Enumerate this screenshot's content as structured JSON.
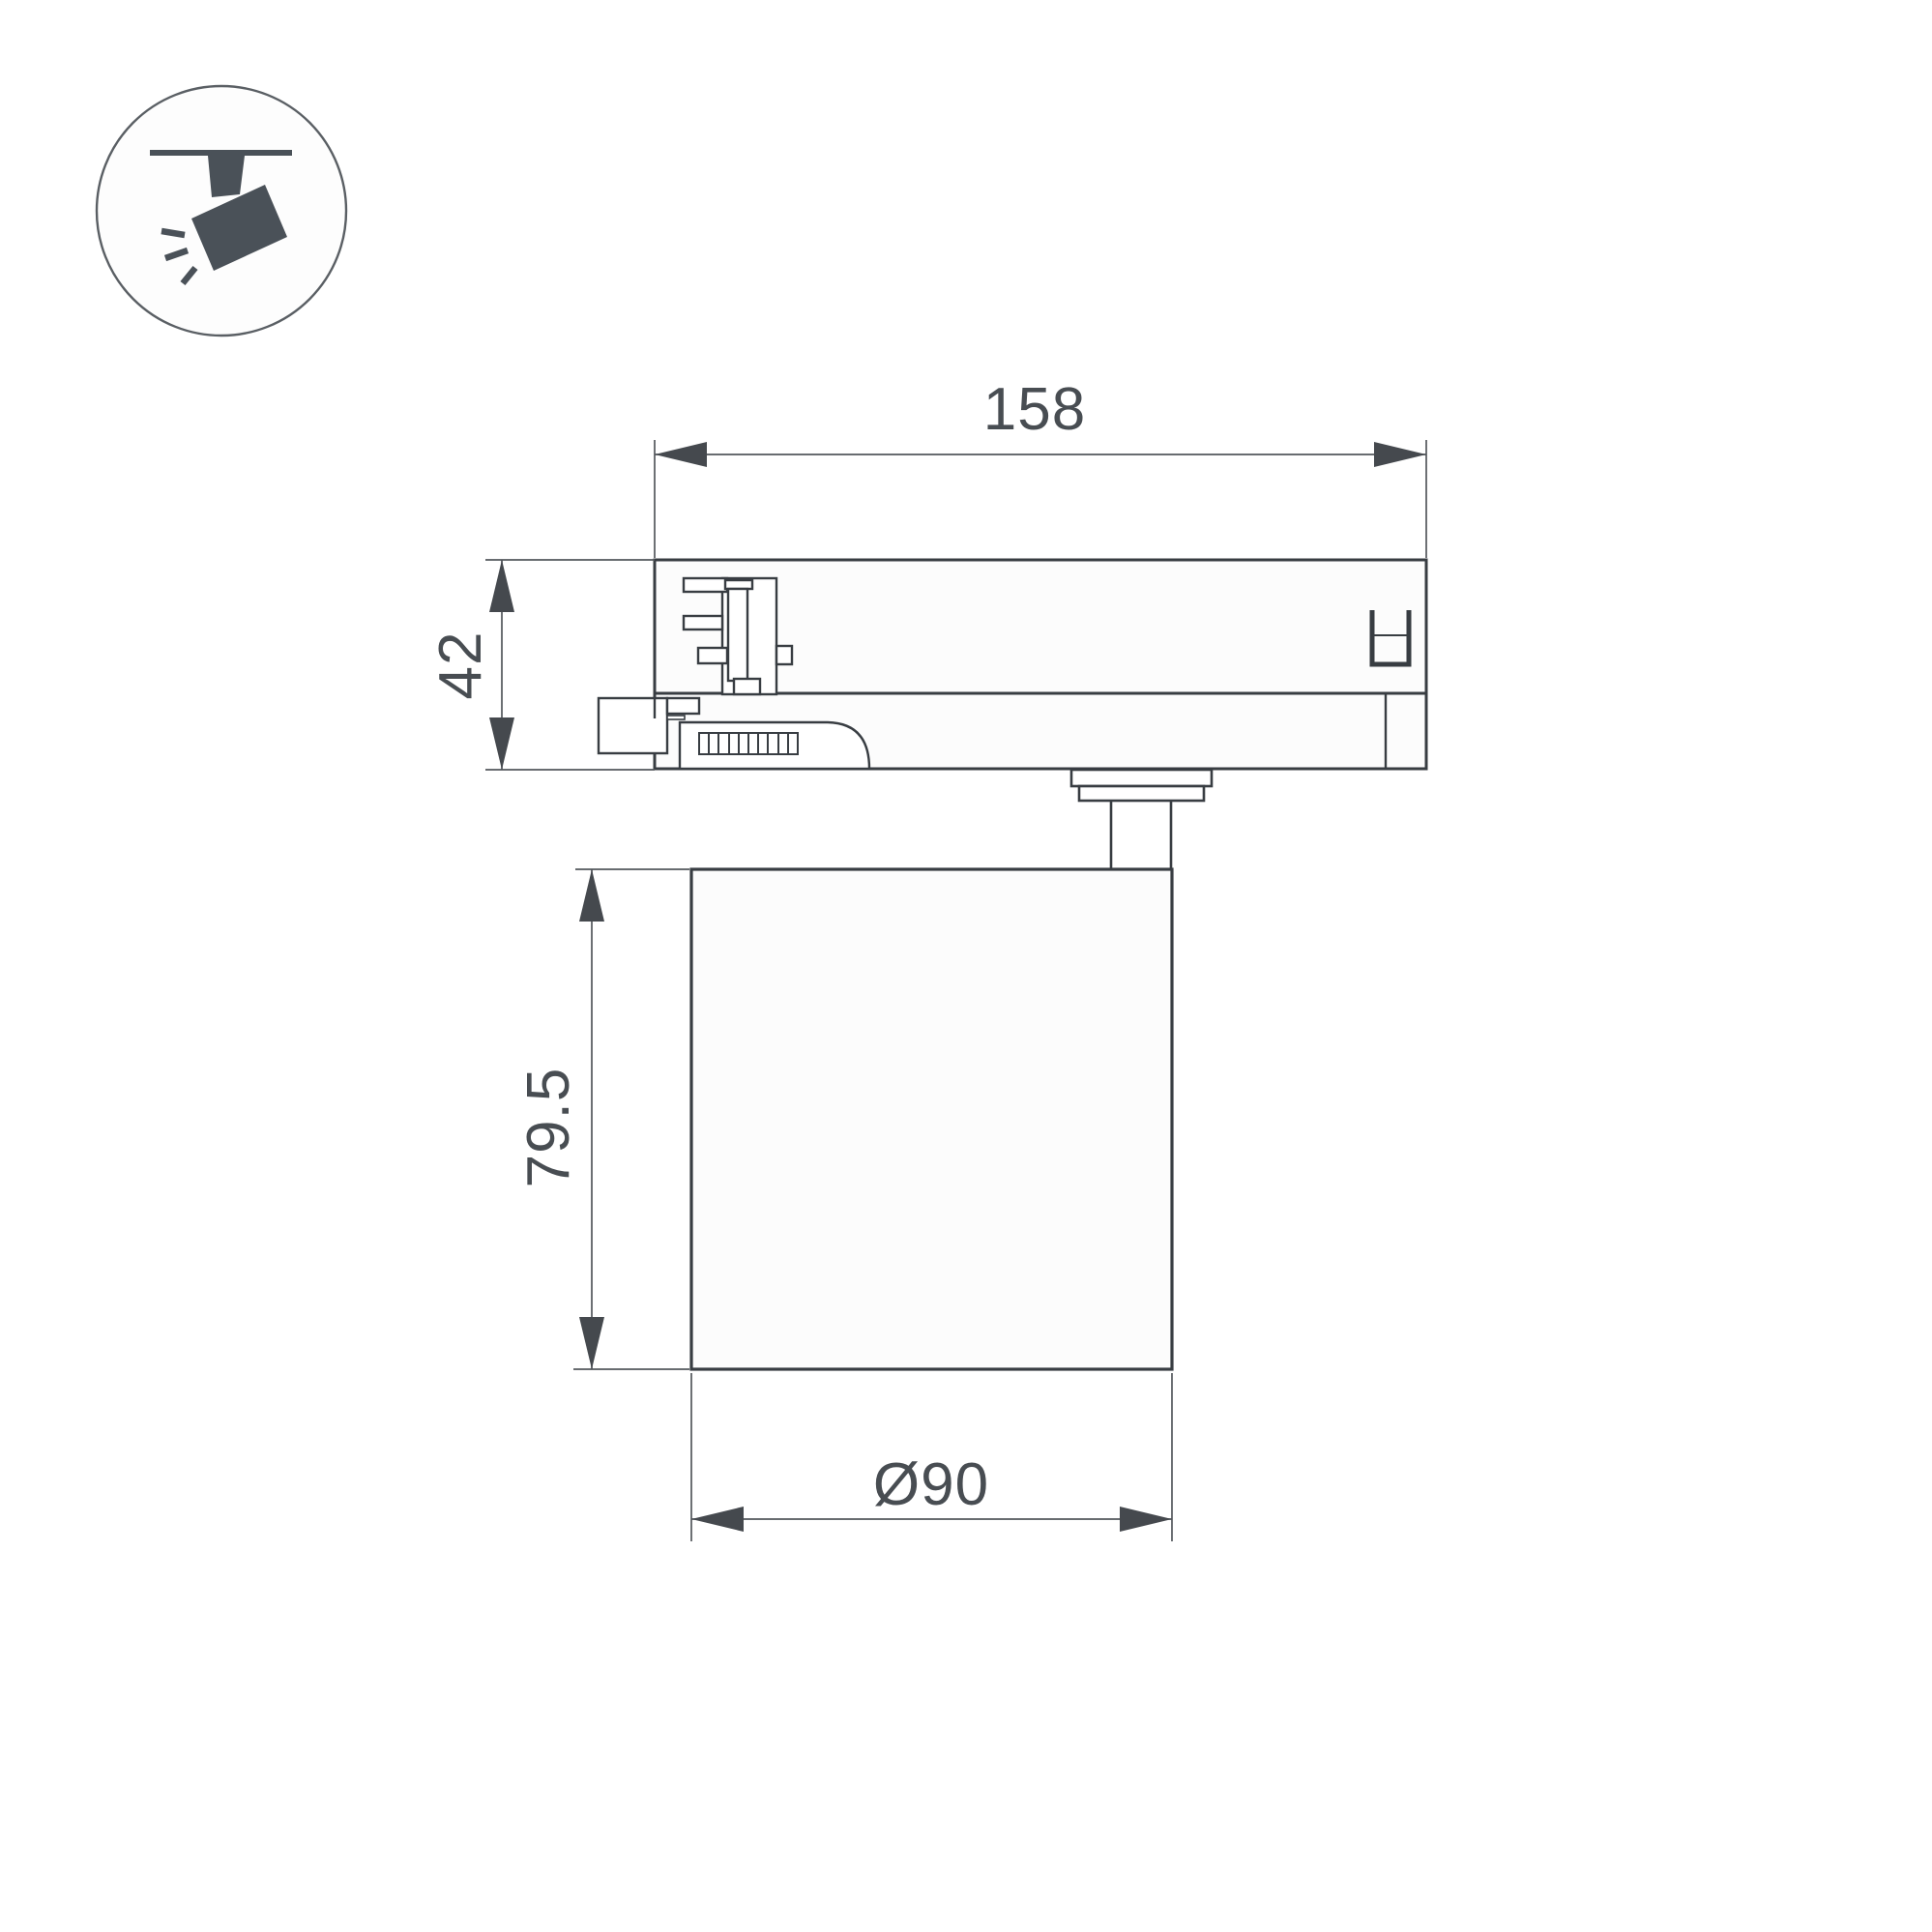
{
  "drawing": {
    "type": "technical-dimension-drawing",
    "subject": "track-mounted spotlight, side elevation",
    "dimensions": {
      "adapter_width": "158",
      "adapter_height": "42",
      "body_height": "79.5",
      "body_diameter": "Ø90"
    }
  },
  "icon": {
    "name": "track-spotlight-pictogram"
  },
  "colors": {
    "background": "#ffffff",
    "outline": "#383d42",
    "dimension_line": "#53575c",
    "dimension_text": "#484d52",
    "icon_fill": "#4a5158"
  }
}
